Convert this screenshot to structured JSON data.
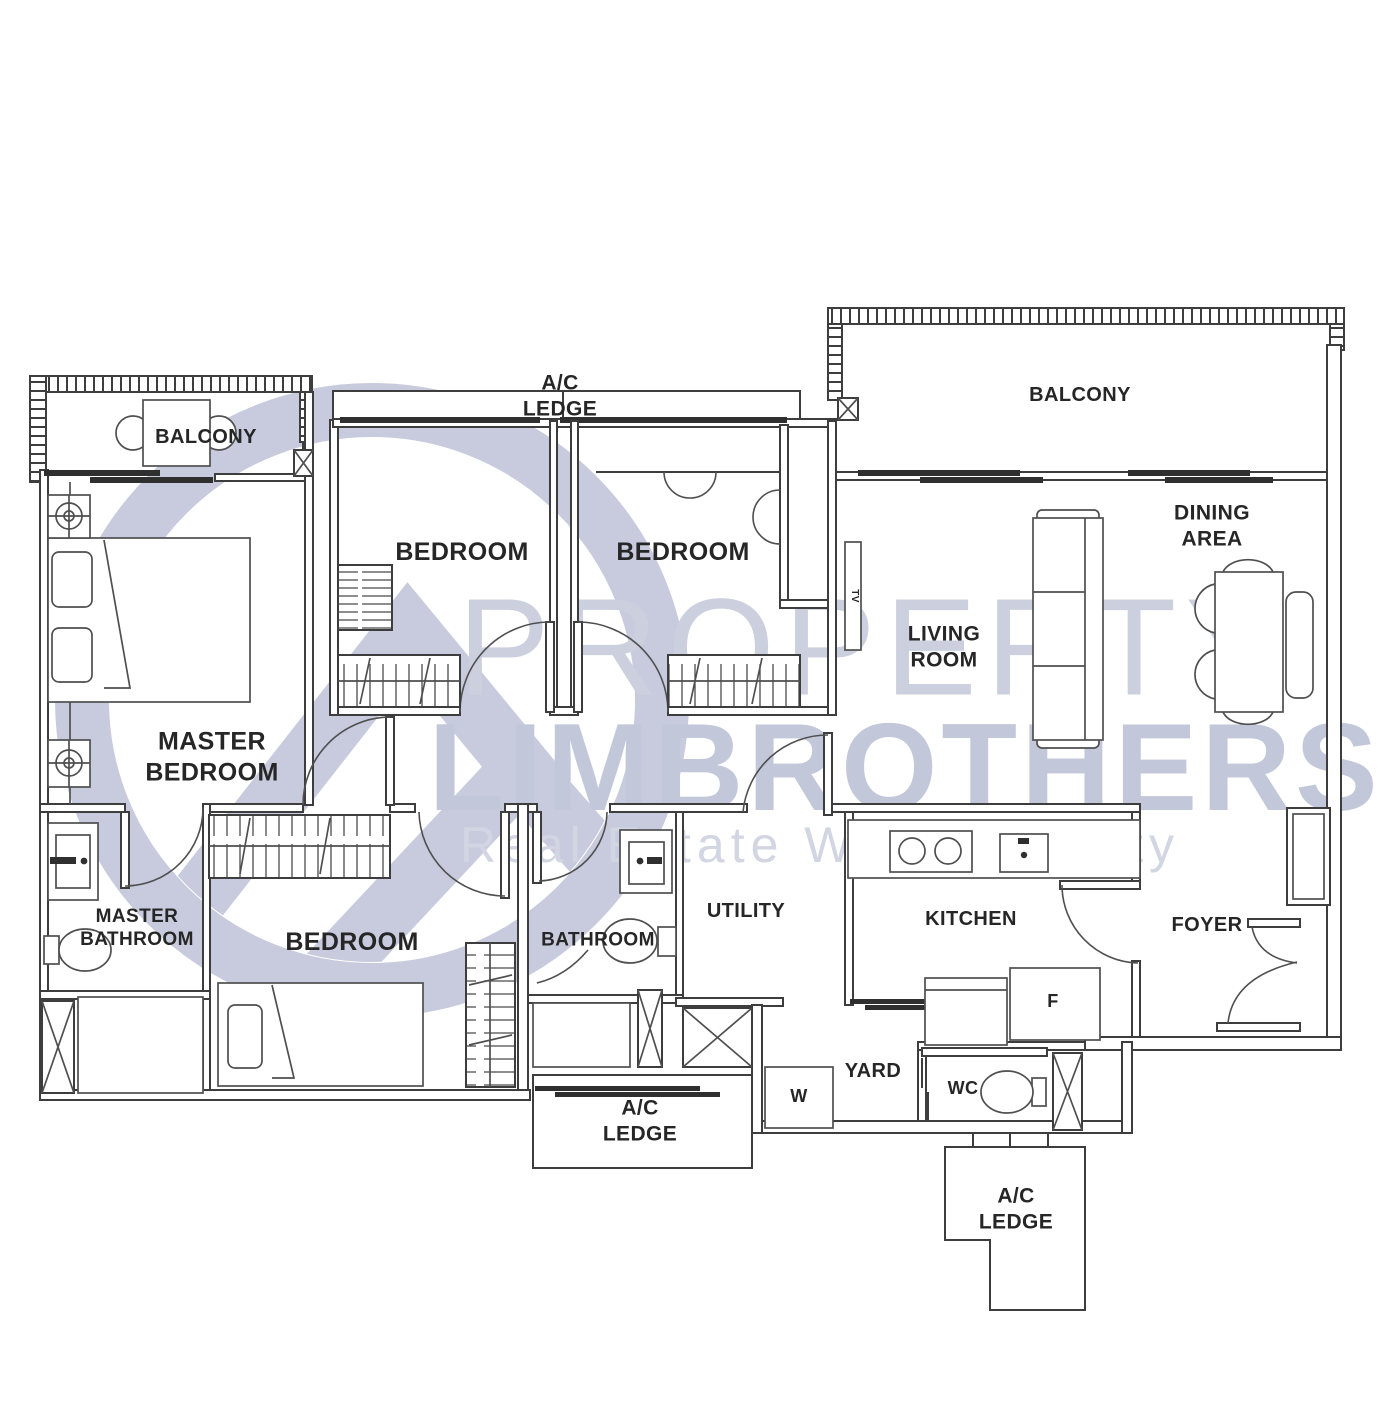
{
  "watermark": {
    "line1": "PROPERTY",
    "line2": "LIMBROTHERS",
    "tagline": "Real Estate With Integrity"
  },
  "colors": {
    "background": "#ffffff",
    "wall": "#3d3d3d",
    "fixture_line": "#4f4f4f",
    "dark_fill": "#2f2f2f",
    "label_text": "#262626",
    "watermark_ring": "#c7cbdd",
    "watermark_text": "#ccd0de",
    "watermark_bold": "#c2c7da",
    "watermark_sub": "#d2d5e2"
  },
  "icons": [
    "bed-icon",
    "sofa-icon",
    "dining-table-icon",
    "toilet-icon",
    "sink-icon",
    "stove-icon",
    "wardrobe-icon",
    "column-icon",
    "ceiling-symbol-icon",
    "door-swing-icon"
  ],
  "rooms": [
    {
      "id": "balcony-left",
      "lines": [
        "BALCONY"
      ],
      "x": 206,
      "y": 437,
      "size": 20
    },
    {
      "id": "ac-ledge-top",
      "lines": [
        "A/C",
        "LEDGE"
      ],
      "x": 560,
      "y": 396,
      "size": 21
    },
    {
      "id": "bedroom-1",
      "lines": [
        "BEDROOM"
      ],
      "x": 462,
      "y": 552,
      "size": 25
    },
    {
      "id": "bedroom-2",
      "lines": [
        "BEDROOM"
      ],
      "x": 683,
      "y": 552,
      "size": 25
    },
    {
      "id": "balcony-right",
      "lines": [
        "BALCONY"
      ],
      "x": 1080,
      "y": 395,
      "size": 20
    },
    {
      "id": "dining-area",
      "lines": [
        "DINING",
        "AREA"
      ],
      "x": 1212,
      "y": 526,
      "size": 21
    },
    {
      "id": "living-room",
      "lines": [
        "LIVING",
        "ROOM"
      ],
      "x": 944,
      "y": 647,
      "size": 21
    },
    {
      "id": "master-bedroom",
      "lines": [
        "MASTER",
        "BEDROOM"
      ],
      "x": 212,
      "y": 757,
      "size": 25
    },
    {
      "id": "master-bathroom",
      "lines": [
        "MASTER",
        "BATHROOM"
      ],
      "x": 137,
      "y": 928,
      "size": 19
    },
    {
      "id": "bedroom-3",
      "lines": [
        "BEDROOM"
      ],
      "x": 352,
      "y": 942,
      "size": 25
    },
    {
      "id": "bathroom",
      "lines": [
        "BATHROOM"
      ],
      "x": 598,
      "y": 940,
      "size": 19
    },
    {
      "id": "utility",
      "lines": [
        "UTILITY"
      ],
      "x": 746,
      "y": 911,
      "size": 20
    },
    {
      "id": "kitchen",
      "lines": [
        "KITCHEN"
      ],
      "x": 971,
      "y": 919,
      "size": 20
    },
    {
      "id": "foyer",
      "lines": [
        "FOYER"
      ],
      "x": 1207,
      "y": 925,
      "size": 20
    },
    {
      "id": "yard",
      "lines": [
        "YARD"
      ],
      "x": 873,
      "y": 1071,
      "size": 20
    },
    {
      "id": "washer",
      "lines": [
        "W"
      ],
      "x": 799,
      "y": 1097,
      "size": 18
    },
    {
      "id": "wc",
      "lines": [
        "WC"
      ],
      "x": 963,
      "y": 1089,
      "size": 18
    },
    {
      "id": "fridge",
      "lines": [
        "F"
      ],
      "x": 1053,
      "y": 1002,
      "size": 18
    },
    {
      "id": "tv",
      "lines": [
        "TV"
      ],
      "x": 854,
      "y": 596,
      "size": 10,
      "rot": 90
    },
    {
      "id": "ac-ledge-bottom-left",
      "lines": [
        "A/C",
        "LEDGE"
      ],
      "x": 640,
      "y": 1121,
      "size": 21
    },
    {
      "id": "ac-ledge-bottom-right",
      "lines": [
        "A/C",
        "LEDGE"
      ],
      "x": 1016,
      "y": 1209,
      "size": 21
    }
  ]
}
